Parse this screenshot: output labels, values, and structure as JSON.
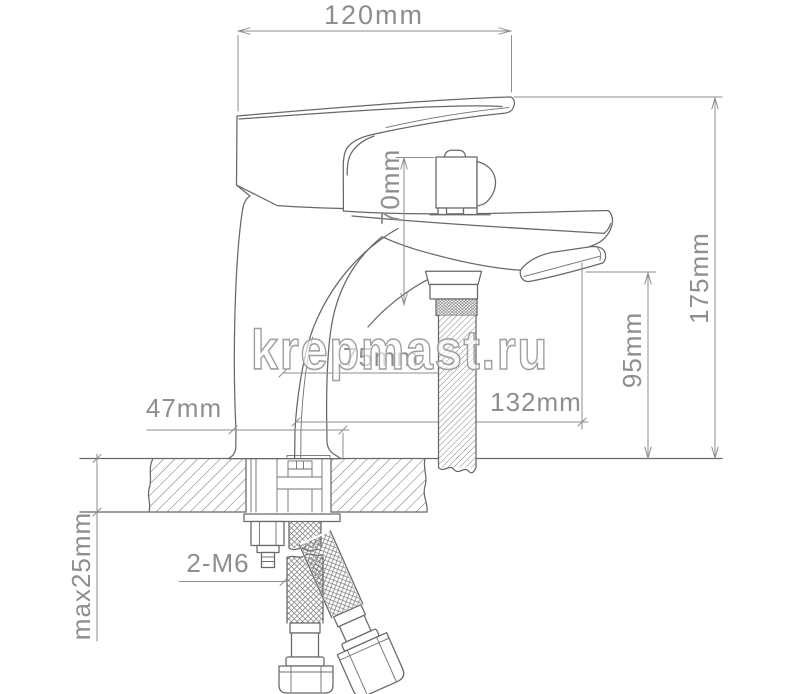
{
  "watermark": {
    "text": "krepmast.ru"
  },
  "drawing": {
    "title": "faucet-technical-drawing",
    "dimensions": {
      "top_width": "120mm",
      "body_to_spout_height": "70mm",
      "total_height": "175mm",
      "outlet_height": "95mm",
      "reach": "132mm",
      "center_offset": "75mm",
      "base_width": "47mm",
      "deck_thickness": "max25mm",
      "thread_label": "2-M6"
    },
    "colors": {
      "outline": "#686868",
      "dimension": "#8e8e8e",
      "watermark_outline": "#a0a0a0",
      "background": "#ffffff"
    }
  }
}
